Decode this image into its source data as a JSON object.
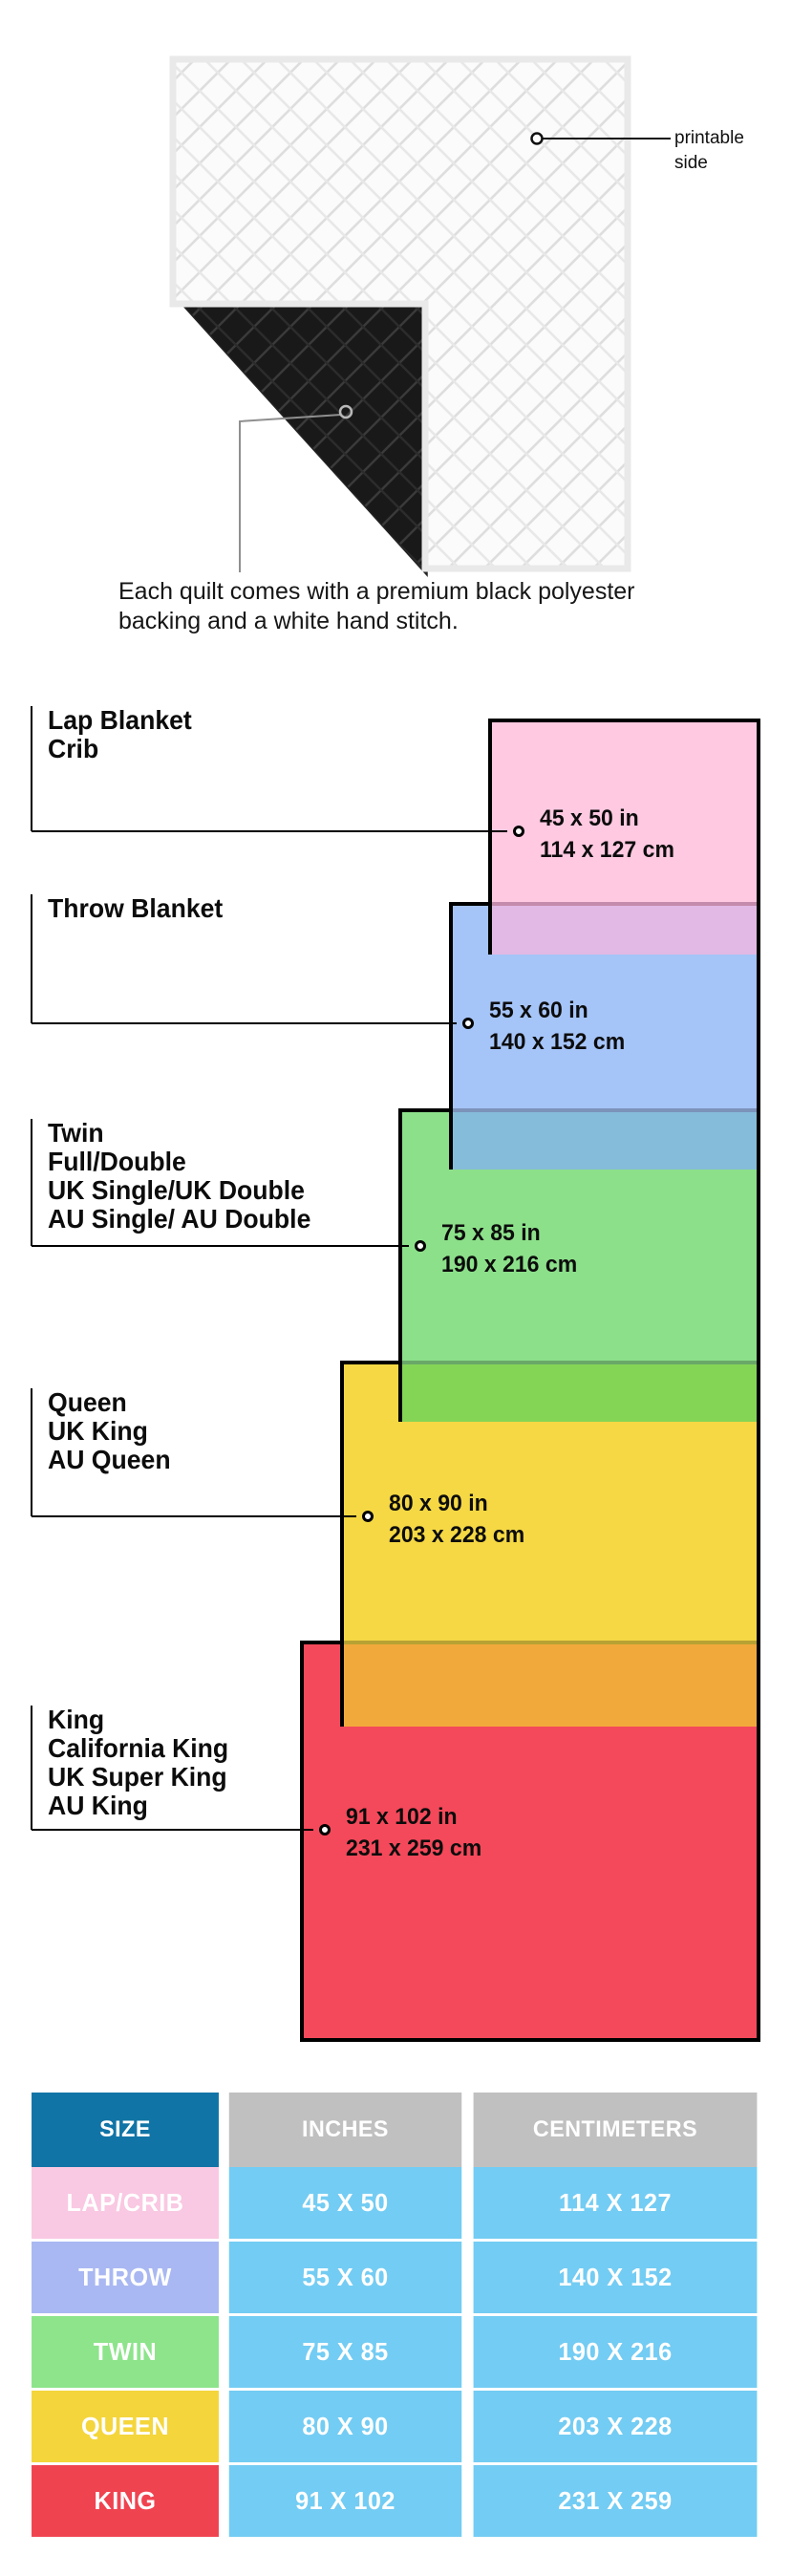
{
  "quilt": {
    "printable_side_label": "printable side",
    "caption": "Each quilt comes with a premium black polyester backing and a white hand stitch."
  },
  "diagram": {
    "sizes": [
      {
        "id": "lap",
        "label_lines": [
          "Lap Blanket",
          "Crib"
        ],
        "dim_in": "45 x 50 in",
        "dim_cm": "114 x 127 cm",
        "fill": "#FFC9E1",
        "overlap_fill": "#E2B9E4",
        "overlap_edge": "#C48BAD"
      },
      {
        "id": "throw",
        "label_lines": [
          "Throw Blanket"
        ],
        "dim_in": "55 x 60 in",
        "dim_cm": "140 x 152 cm",
        "fill": "#A5C4F8",
        "overlap_fill": "#85BCD9",
        "overlap_edge": "#7C93BA"
      },
      {
        "id": "twin",
        "label_lines": [
          "Twin",
          "Full/Double",
          "UK Single/UK Double",
          "AU Single/ AU Double"
        ],
        "dim_in": "75 x 85 in",
        "dim_cm": "190 x 216 cm",
        "fill": "#8CE08A",
        "overlap_fill": "#84D556",
        "overlap_edge": "#69A868"
      },
      {
        "id": "queen",
        "label_lines": [
          "Queen",
          "UK King",
          "AU Queen"
        ],
        "dim_in": "80 x 90 in",
        "dim_cm": "203 x 228 cm",
        "fill": "#F5D844",
        "overlap_fill": "#F2A93B",
        "overlap_edge": "#B8A233"
      },
      {
        "id": "king",
        "label_lines": [
          "King",
          "California King",
          "UK Super King",
          "AU King"
        ],
        "dim_in": "91 x 102 in",
        "dim_cm": "231 x 259 cm",
        "fill": "#F4495A"
      }
    ]
  },
  "table": {
    "headers": [
      "SIZE",
      "INCHES",
      "CENTIMETERS"
    ],
    "colors": {
      "size_header_bg": "#1174A6",
      "unit_header_bg": "#C0C0C0",
      "data_cell_bg": "#73CCF3"
    },
    "rows": [
      {
        "size": "LAP/CRIB",
        "inches": "45 X 50",
        "centimeters": "114 X 127",
        "color": "#F9C8E2"
      },
      {
        "size": "THROW",
        "inches": "55 X 60",
        "centimeters": "140 X 152",
        "color": "#A9B8F2"
      },
      {
        "size": "TWIN",
        "inches": "75 X 85",
        "centimeters": "190 X 216",
        "color": "#8DE48B"
      },
      {
        "size": "QUEEN",
        "inches": "80 X 90",
        "centimeters": "203 X 228",
        "color": "#F4D53C"
      },
      {
        "size": "KING",
        "inches": "91 X 102",
        "centimeters": "231 X 259",
        "color": "#F04350"
      }
    ]
  }
}
